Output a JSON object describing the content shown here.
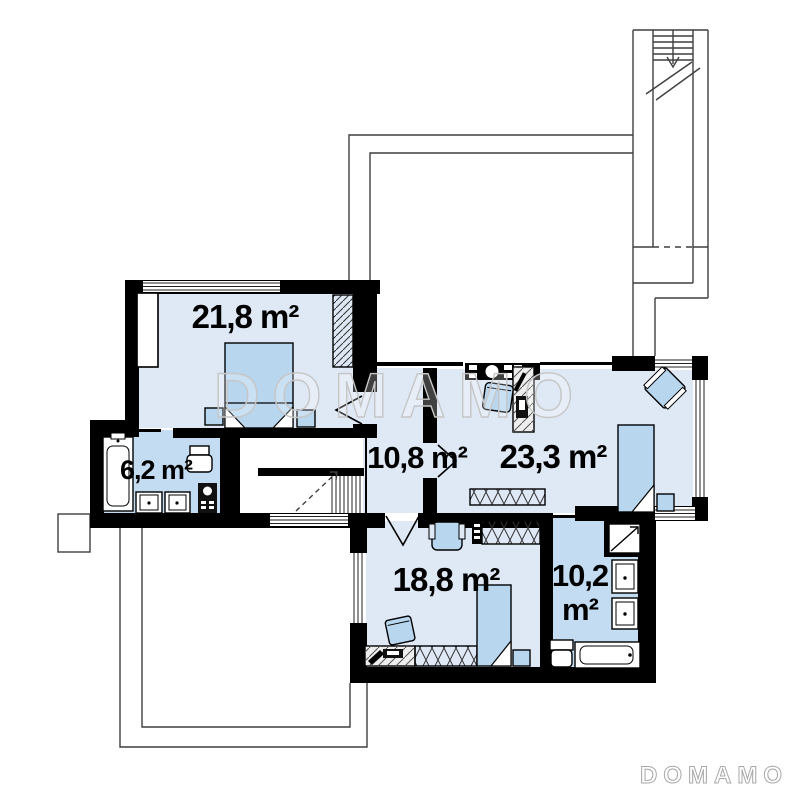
{
  "plan": {
    "rooms": [
      {
        "name": "bedroom-top-left",
        "area": "21,8 m²"
      },
      {
        "name": "bathroom-left",
        "area": "6,2 m²"
      },
      {
        "name": "hall",
        "area": "10,8 m²"
      },
      {
        "name": "bedroom-right",
        "area": "23,3 m²"
      },
      {
        "name": "bedroom-bottom",
        "area": "18,8 m²"
      },
      {
        "name": "bathroom-bottom-right",
        "area_line1": "10,2",
        "area_line2": "m²"
      }
    ]
  },
  "watermark": {
    "center_text": "DOMAMO",
    "corner_text": "DOMAMO"
  },
  "colors": {
    "wall": "#000000",
    "room_fill": "#dfe9f6",
    "bathroom_fill": "#c3dcf2",
    "furniture_fill": "#b9d6ef",
    "thin_outline": "#3f3f3f",
    "watermark_outline": "#c6c6c6",
    "label_text": "#000000"
  }
}
